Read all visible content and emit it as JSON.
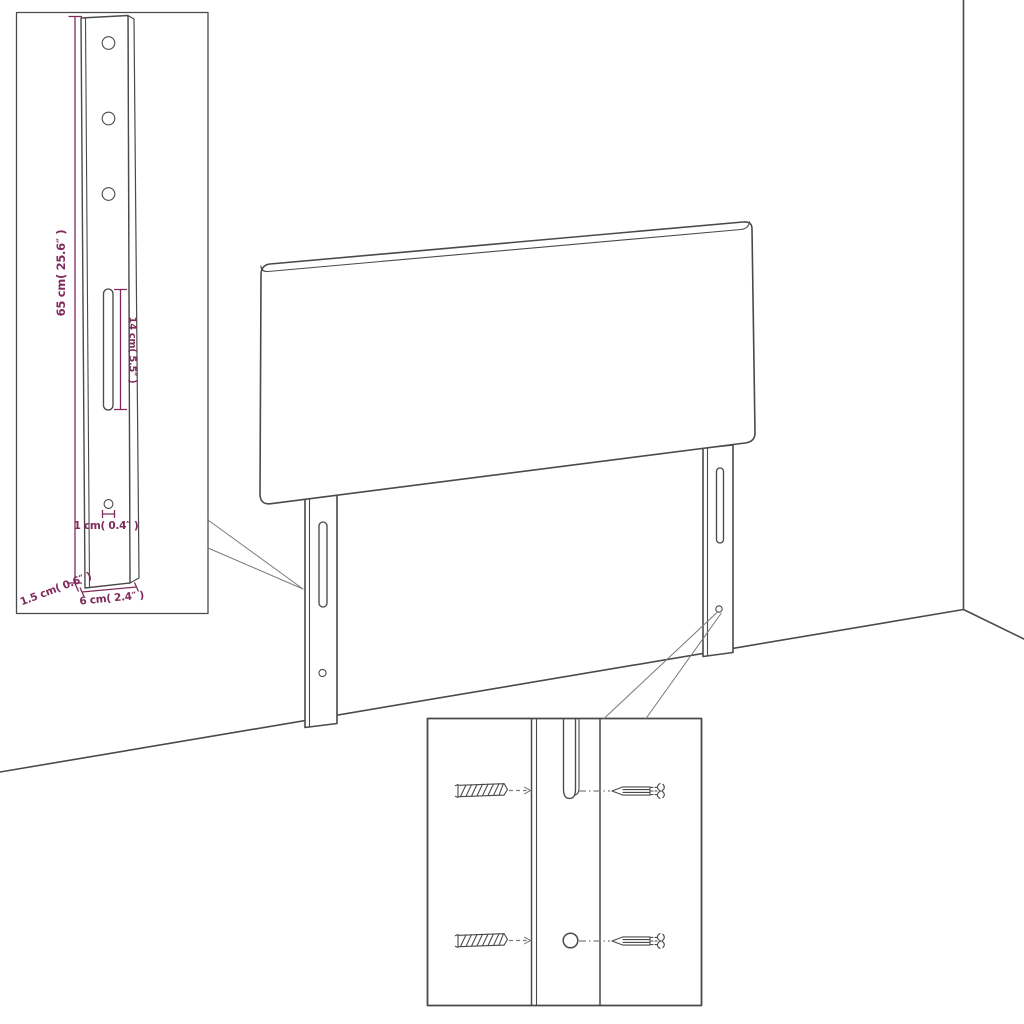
{
  "diagram": {
    "colors": {
      "line": "#4a4a4a",
      "dimension_accent": "#802a5c",
      "background": "#ffffff"
    },
    "leg_detail_inset": {
      "dimensions": {
        "leg_height": "65 cm( 25.6″ )",
        "slot_length": "14 cm( 5.5″ )",
        "hole_diameter": "1 cm( 0.4″ )",
        "leg_depth": "1.5 cm( 0.6″ )",
        "leg_width": "6 cm( 2.4″ )"
      }
    }
  }
}
